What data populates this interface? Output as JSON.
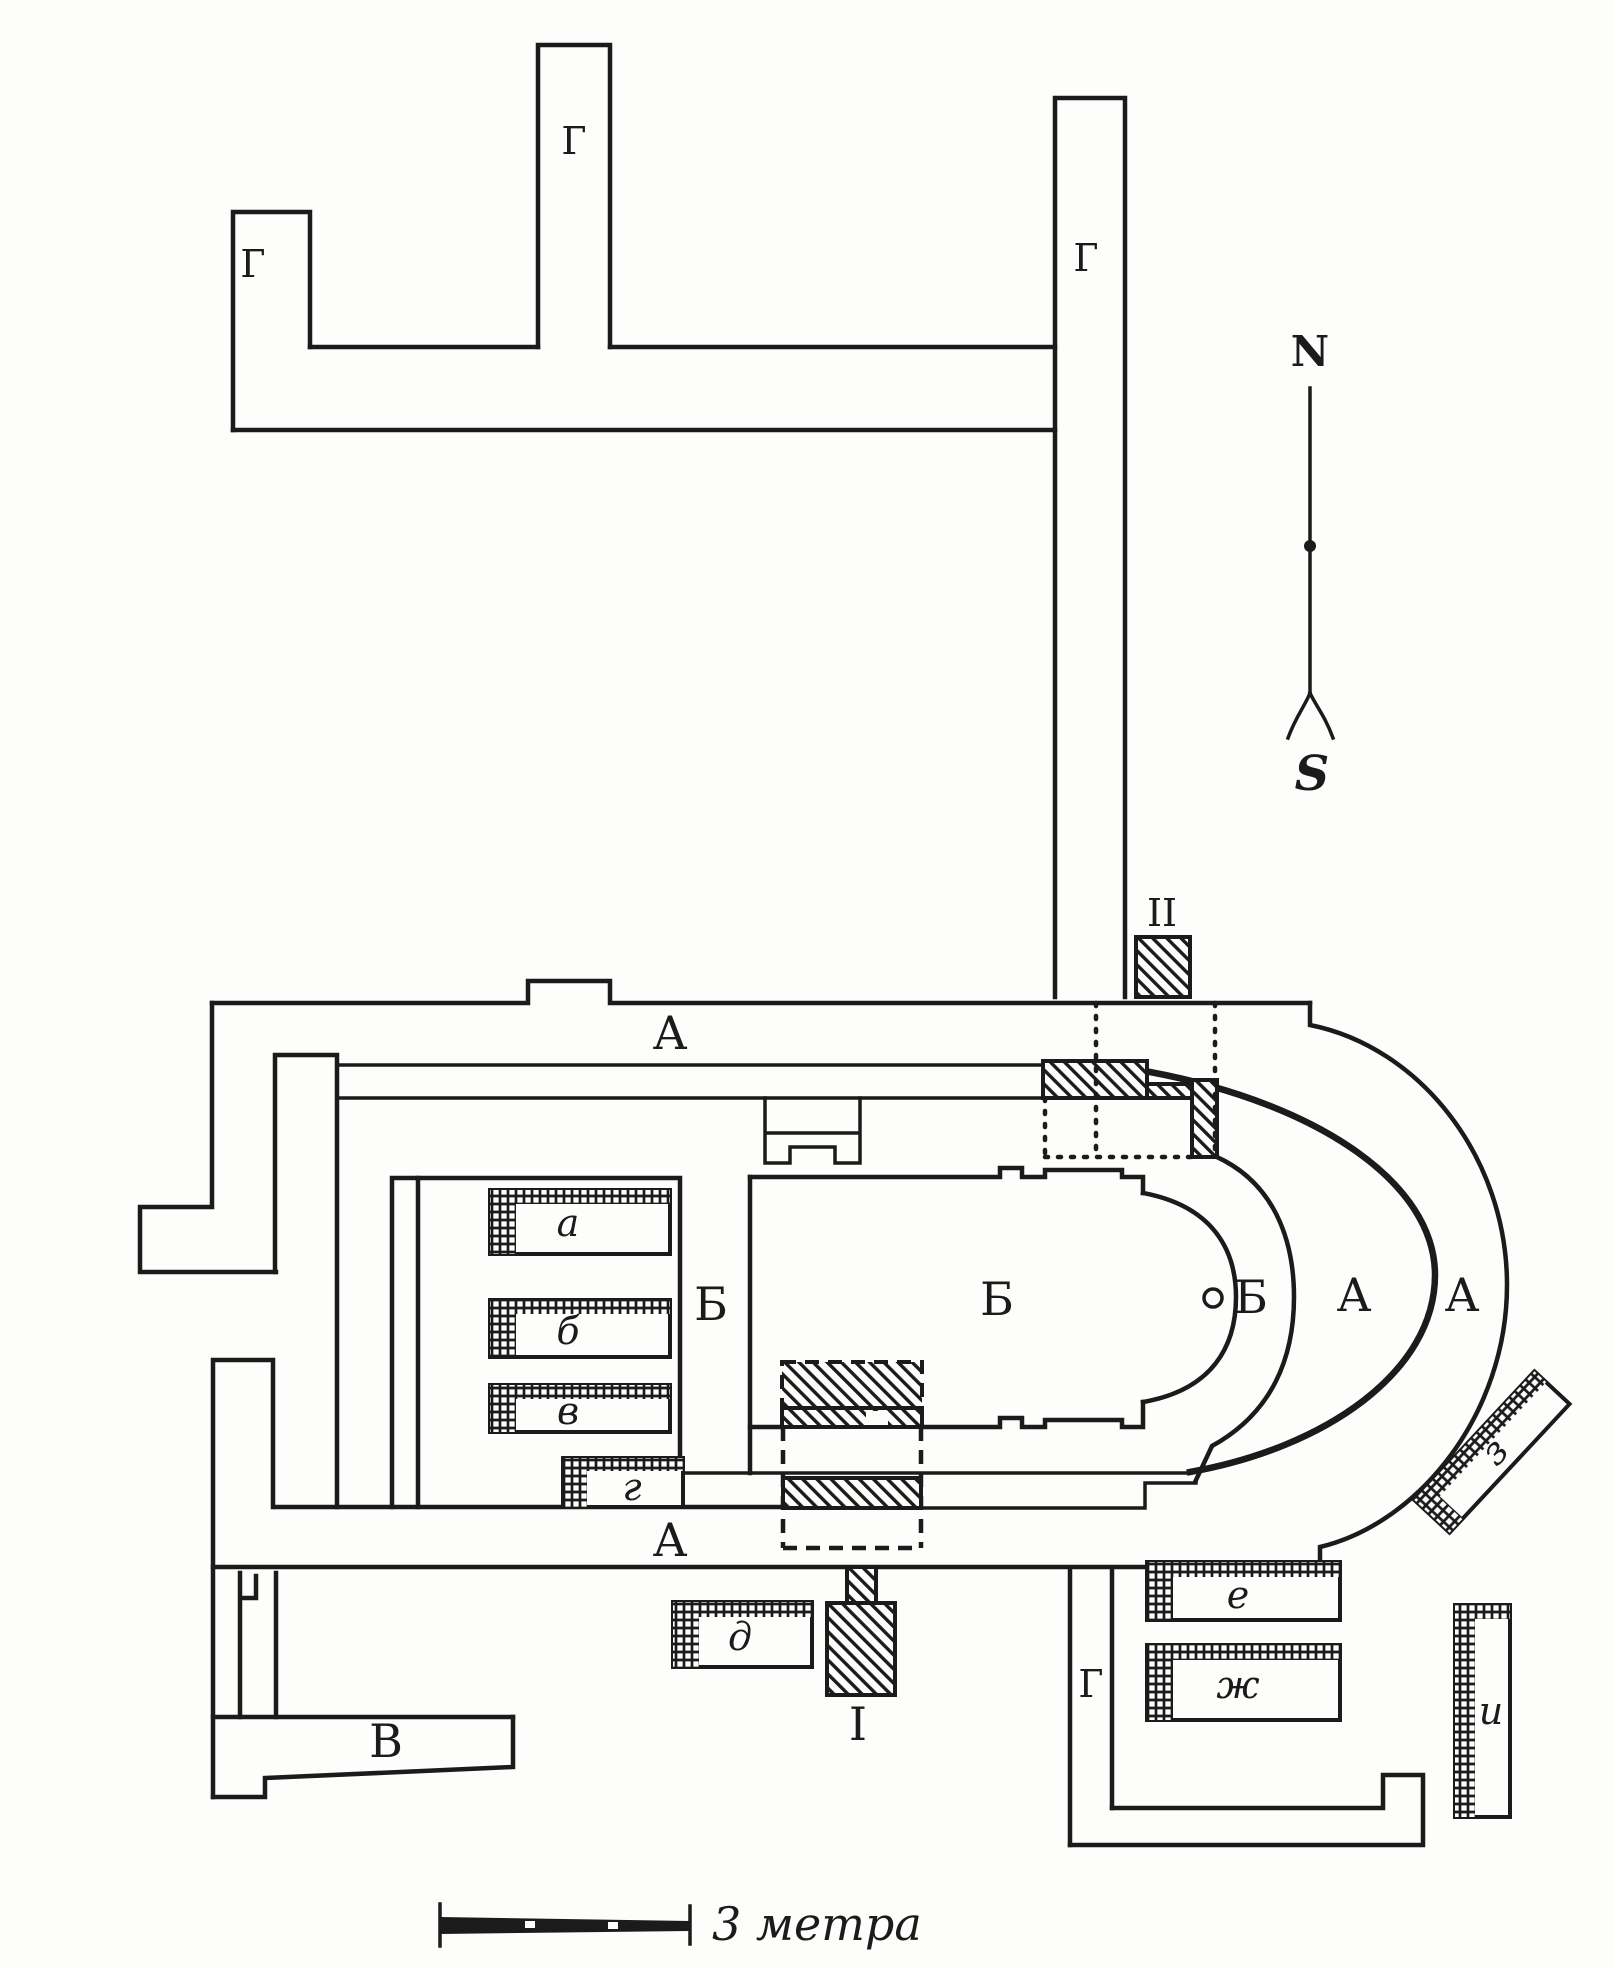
{
  "colors": {
    "ink": "#1b1b1b",
    "paper": "#fdfdfb"
  },
  "compass": {
    "north": "N",
    "south": "S"
  },
  "scale_bar": {
    "label": "3 метра"
  },
  "labels": {
    "gallery": "Г",
    "aisle": "А",
    "nave": "Б",
    "annex": "В",
    "portal_one": "I",
    "portal_two": "II"
  },
  "benches": {
    "a": "а",
    "b": "б",
    "v": "в",
    "g": "г",
    "d": "д",
    "e": "е",
    "zh": "ж",
    "z": "з",
    "i": "и"
  }
}
